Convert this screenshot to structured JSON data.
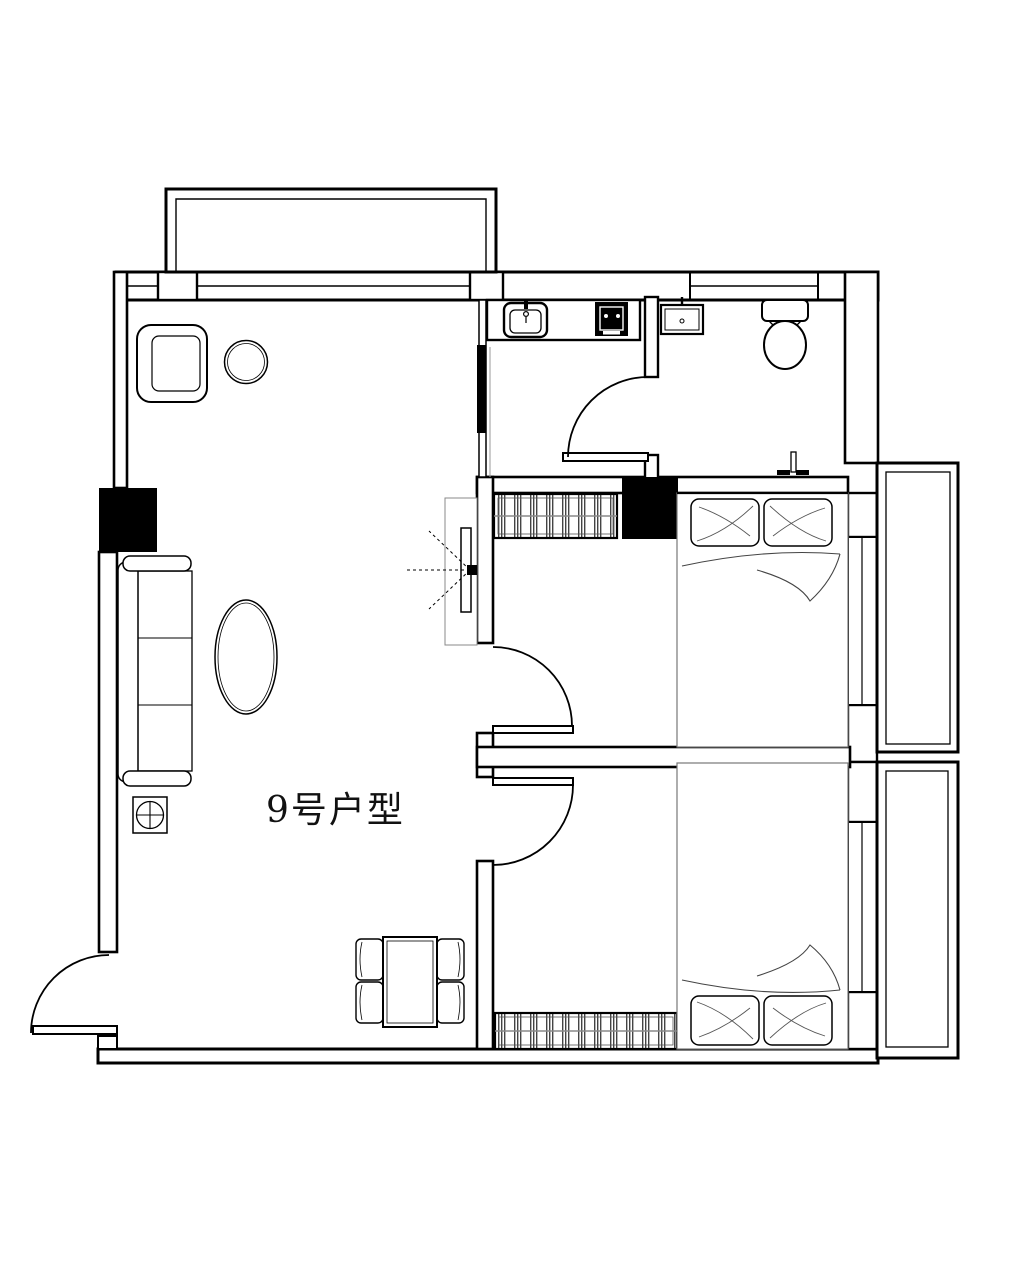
{
  "plan": {
    "label": "9号户型",
    "background_color": "#ffffff",
    "line_color": "#000000",
    "rooms": [
      "living-room",
      "kitchen",
      "bathroom",
      "bedroom-1",
      "bedroom-2",
      "balcony-top",
      "balcony-right-upper",
      "balcony-right-lower",
      "entry"
    ],
    "furniture_icons": [
      "armchair-icon",
      "stool-icon",
      "sofa-icon",
      "coffee-table-icon",
      "planter-icon",
      "tv-cabinet-icon",
      "dining-table-icon",
      "dining-chair-icon",
      "kitchen-counter-icon",
      "kitchen-sink-icon",
      "stove-icon",
      "bathroom-sink-icon",
      "toilet-icon",
      "wall-faucet-icon",
      "closet-icon",
      "double-bed-icon",
      "wardrobe-icon",
      "door-swing-icon",
      "window-icon",
      "column-icon"
    ]
  }
}
